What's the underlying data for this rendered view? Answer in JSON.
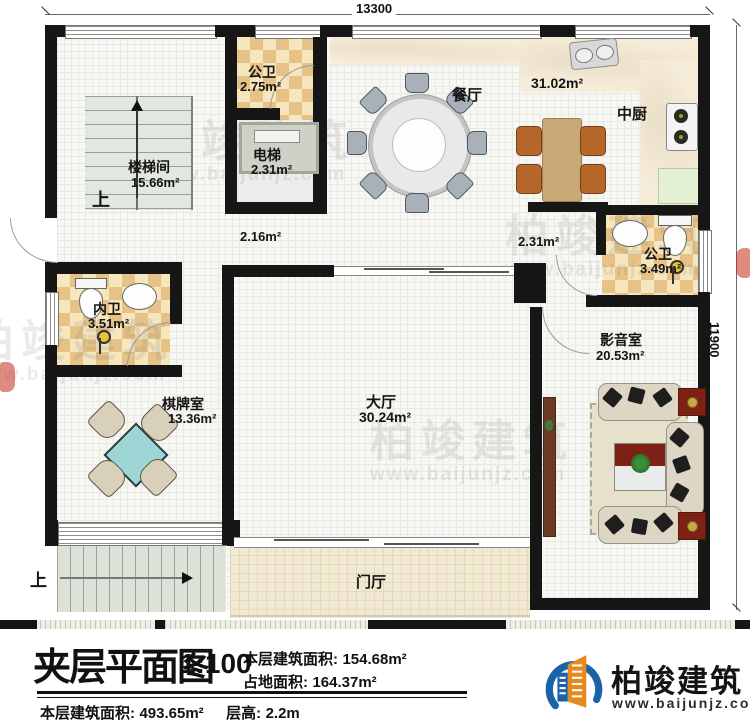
{
  "dims": {
    "width": "13300",
    "height": "11900"
  },
  "rooms": {
    "gongwei1": {
      "name": "公卫",
      "area": "2.75m²"
    },
    "canting": {
      "name": "餐厅",
      "area": "31.02m²"
    },
    "zhongchu": {
      "name": "中厨"
    },
    "loutijian": {
      "name": "楼梯间",
      "area": "15.66m²"
    },
    "dianti": {
      "name": "电梯",
      "area": "2.31m²"
    },
    "gongwei2": {
      "name": "公卫",
      "area": "3.49m²"
    },
    "neiwei": {
      "name": "内卫",
      "area": "3.51m²"
    },
    "yingyinshi": {
      "name": "影音室",
      "area": "20.53m²"
    },
    "qipaishi": {
      "name": "棋牌室",
      "area": "13.36m²"
    },
    "dating": {
      "name": "大厅",
      "area": "30.24m²"
    },
    "menting": {
      "name": "门厅"
    }
  },
  "passages": {
    "p1": "2.16m²",
    "p2": "2.31m²"
  },
  "stairs": {
    "up": "上"
  },
  "title_block": {
    "title": "夹层平面图",
    "scale": "1:100",
    "floor_area_label": "本层建筑面积:",
    "floor_area_value": "154.68m²",
    "land_area_label": "占地面积:",
    "land_area_value": "164.37m²",
    "total_area_label": "本层建筑面积:",
    "total_area_value": "493.65m²",
    "height_label": "层高:",
    "height_value": "2.2m"
  },
  "brand": {
    "name": "柏竣建筑",
    "url": "www.baijunjz.com"
  },
  "watermark": {
    "name": "柏竣建筑",
    "url": "www.baijunjz.com"
  },
  "colors": {
    "wall": "#161616",
    "checker": "#e6c286",
    "mahjong_table": "#9ed6d6",
    "brand_blue": "#1b63a8",
    "brand_orange": "#e8891d"
  }
}
